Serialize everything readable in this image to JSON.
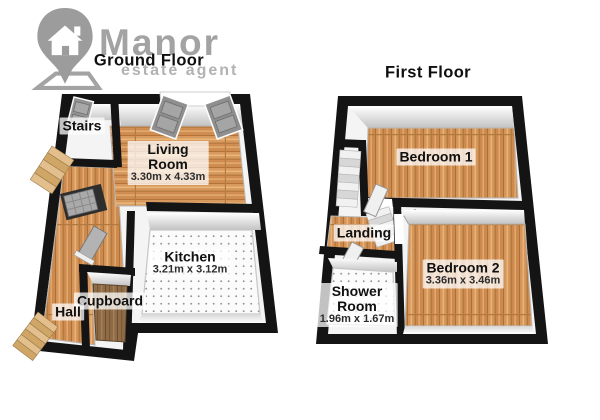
{
  "logo": {
    "brand": "Manor",
    "tagline": "estate agent",
    "icon": "house-location-pin-icon"
  },
  "floors": [
    {
      "title": "Ground Floor",
      "rooms": [
        {
          "name": "Stairs",
          "dims": ""
        },
        {
          "name": "Living Room",
          "dims": "3.30m x 4.33m"
        },
        {
          "name": "Kitchen",
          "dims": "3.21m x 3.12m"
        },
        {
          "name": "Cupboard",
          "dims": ""
        },
        {
          "name": "Hall",
          "dims": ""
        }
      ]
    },
    {
      "title": "First Floor",
      "rooms": [
        {
          "name": "Bedroom 1",
          "dims": ""
        },
        {
          "name": "Landing",
          "dims": ""
        },
        {
          "name": "Shower Room",
          "dims": "1.96m x 1.67m"
        },
        {
          "name": "Bedroom 2",
          "dims": "3.36m x 3.46m"
        }
      ]
    }
  ],
  "colors": {
    "wall": "#141414",
    "wood_floor": "#d4955a",
    "dark_wood_floor": "#8f6b47",
    "tile_floor": "#fbfbfb",
    "logo_gray": "#a3a3a3",
    "label_text": "#101010"
  }
}
